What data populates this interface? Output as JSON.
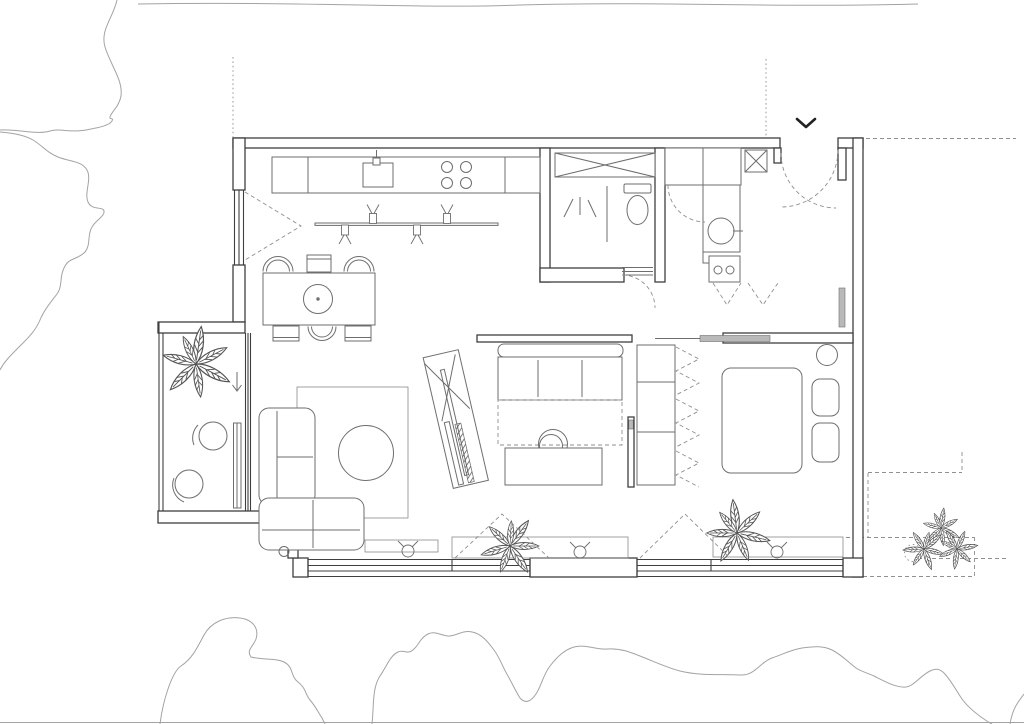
{
  "colors": {
    "background": "#ffffff",
    "wall_line": "#3f3f3f",
    "furniture_line": "#6e6e6e",
    "fine_line": "#8a8a8a",
    "dash_line": "#8f8f8f",
    "tree_line": "#a3a3a3",
    "panel_gray": "#b9b9b9",
    "plant_line": "#565656",
    "shrub_line": "#4a4a4a"
  },
  "plan": {
    "type": "apartment floor plan, top view, black-and-white architectural line drawing",
    "visible_text": [],
    "rooms": [
      {
        "name": "kitchen-dining",
        "items": [
          "kitchen-counter",
          "sink-with-faucet",
          "cooktop-4-burners",
          "track-spotlights-4",
          "dining-table",
          "dining-chairs-6",
          "pendant-lamp-circle"
        ]
      },
      {
        "name": "bathroom",
        "items": [
          "crossed-cabinet",
          "shower-corner",
          "toilet",
          "door-threshold",
          "door-swing-arc"
        ]
      },
      {
        "name": "entry-hall",
        "items": [
          "entrance-opening",
          "entry-chevron-marker",
          "crossed-duct-shaft",
          "hall-closet",
          "washbasin-counter",
          "appliance-knobs",
          "door-swing-arcs"
        ]
      },
      {
        "name": "study-nook",
        "items": [
          "sofa-bed",
          "pull-out-dashed",
          "desk",
          "round-desk-chair",
          "wardrobe-folding-doors",
          "angled-tv-panel"
        ]
      },
      {
        "name": "living-room",
        "items": [
          "corner-sofa",
          "rug",
          "round-coffee-table",
          "window-sill-units",
          "wall-light-symbols"
        ]
      },
      {
        "name": "bedroom",
        "items": [
          "double-bed",
          "two-pillows",
          "round-side-table",
          "sliding-door-panel",
          "radiator",
          "potted-plant",
          "window-sill-unit"
        ]
      },
      {
        "name": "balcony",
        "items": [
          "large-potted-plant",
          "round-stool",
          "round-stool",
          "step-down-arrow",
          "glazed-door-leaf"
        ]
      }
    ],
    "site_context": [
      "tree-canopy-outline-top-left",
      "tree-canopy-outline-top-edge",
      "tree-canopy-outlines-bottom",
      "shrub-cluster-bottom-right",
      "dashed-reference-lines-right",
      "dotted-setback-lines-top",
      "ground-line-bottom"
    ]
  }
}
